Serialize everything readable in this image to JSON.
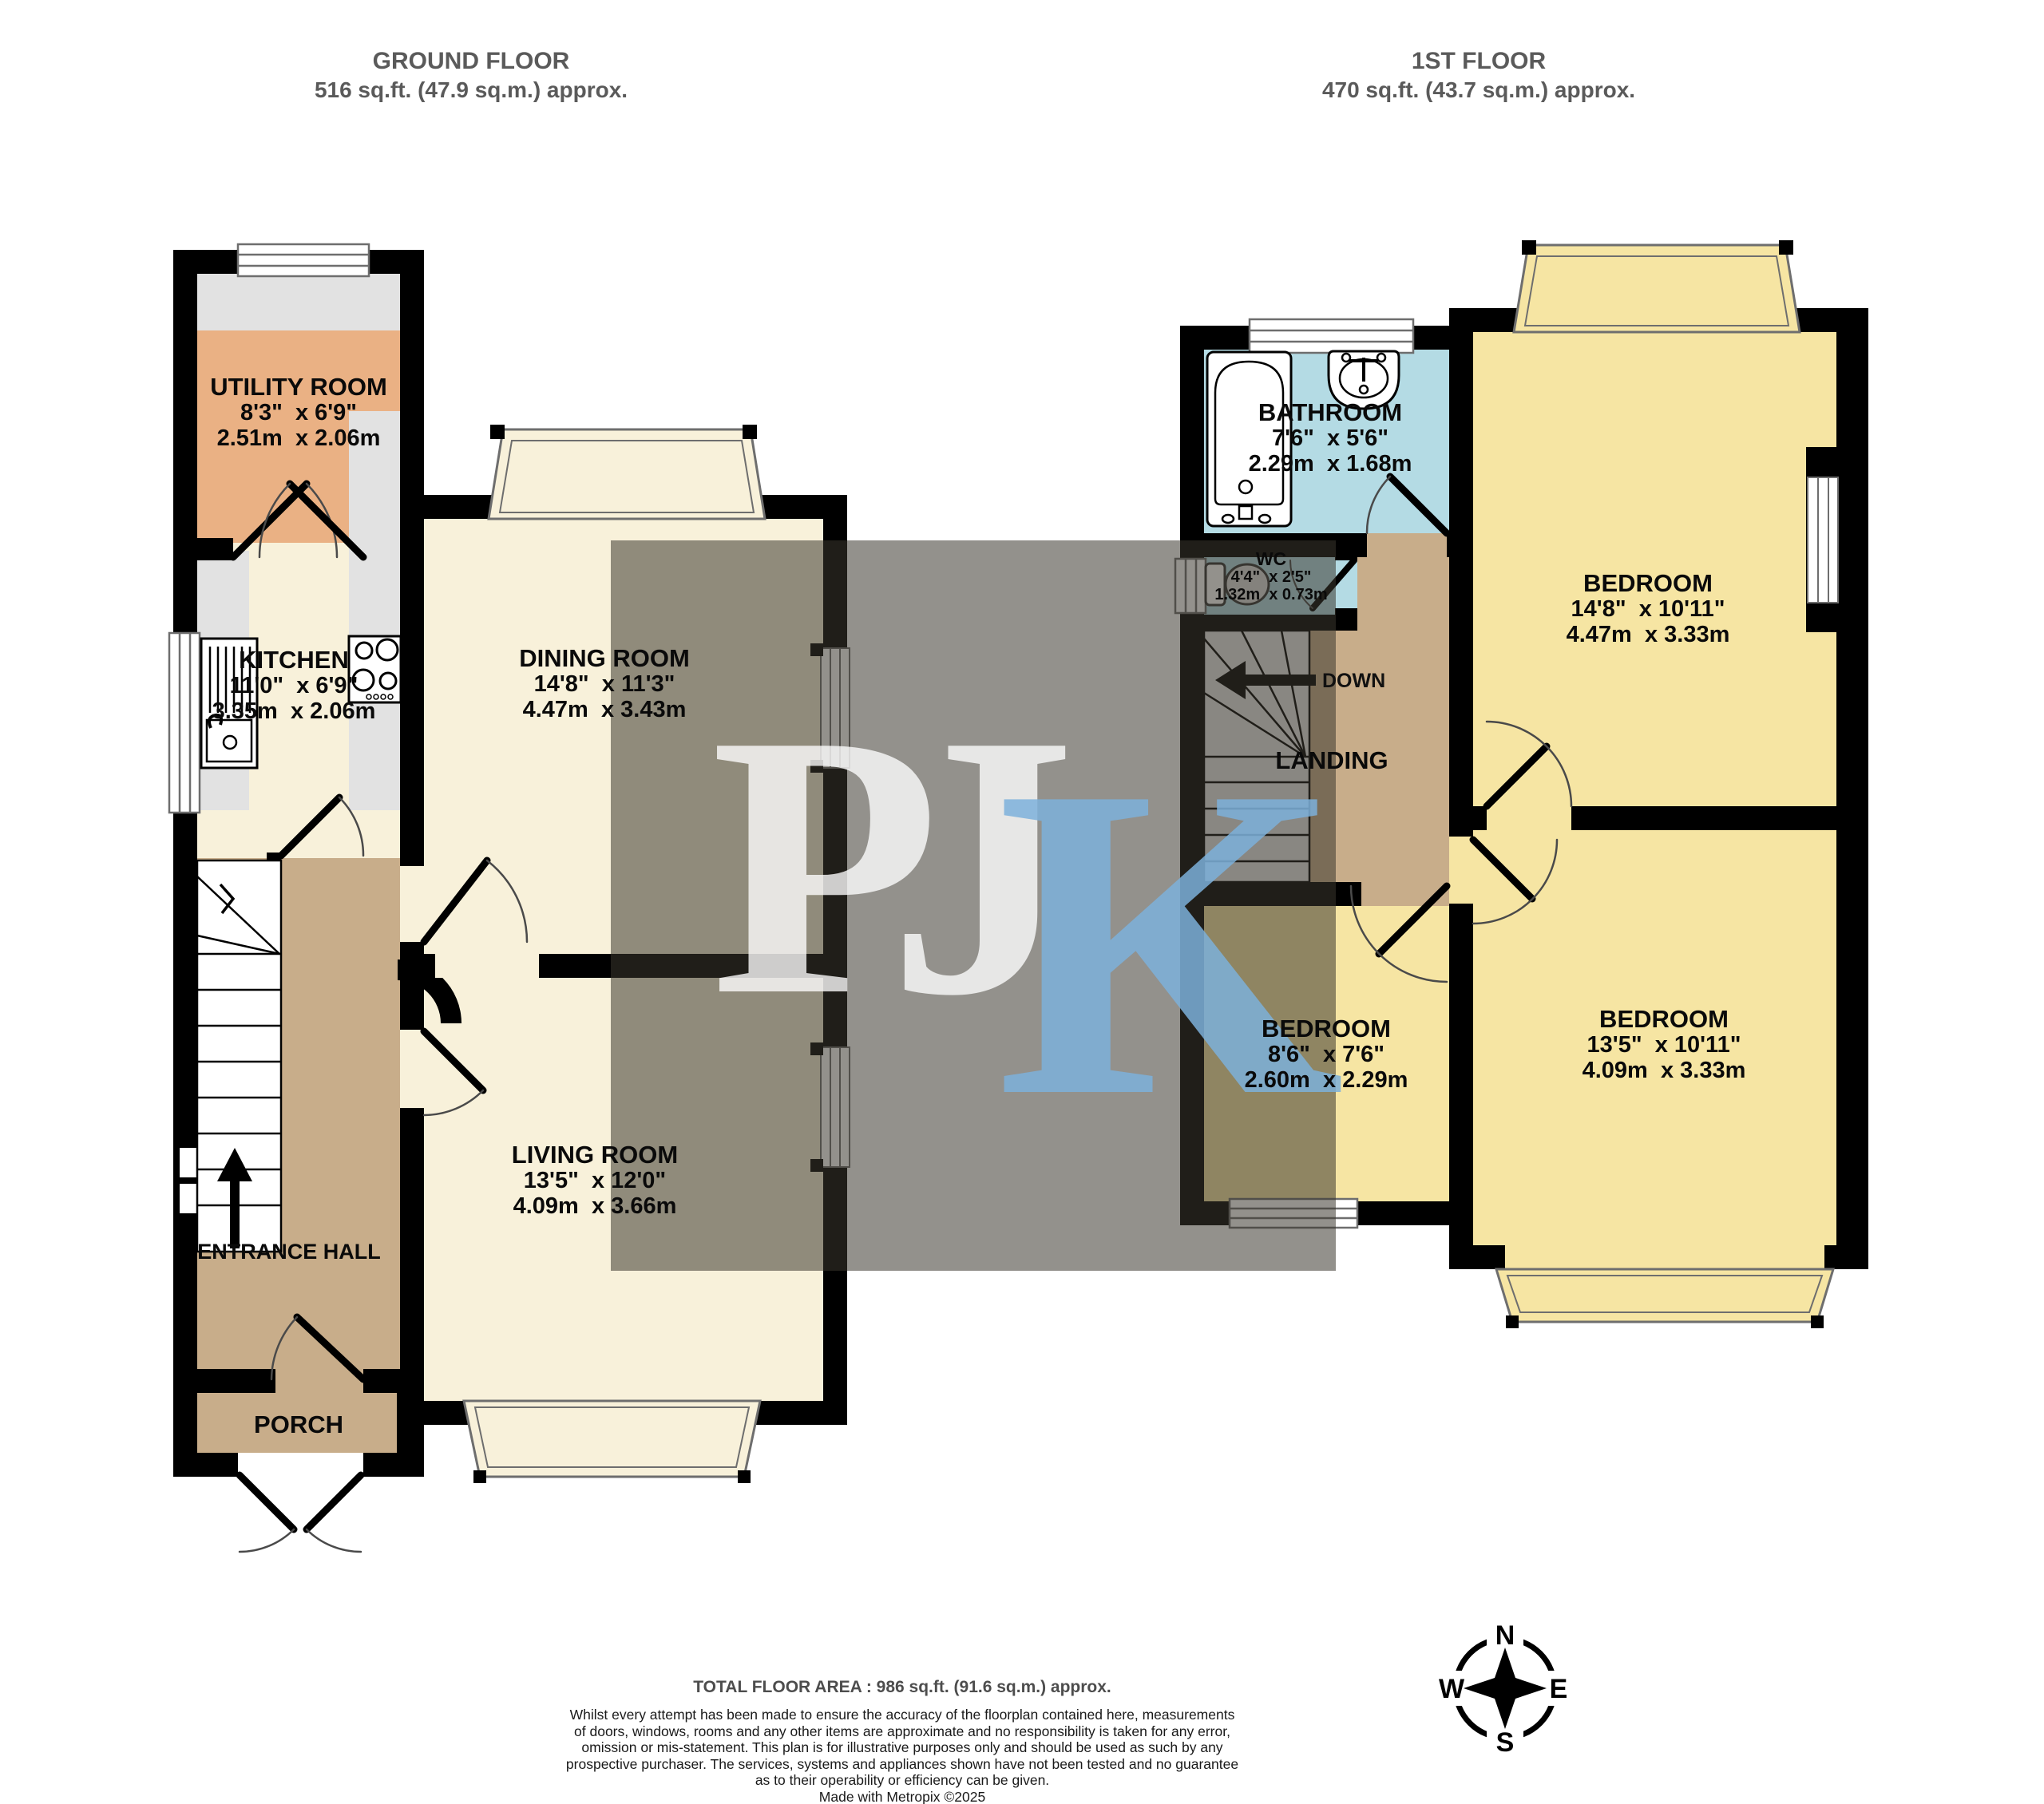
{
  "headers": {
    "ground": {
      "title": "GROUND FLOOR",
      "area": "516 sq.ft. (47.9 sq.m.) approx."
    },
    "first": {
      "title": "1ST FLOOR",
      "area": "470 sq.ft. (43.7 sq.m.) approx."
    }
  },
  "rooms": {
    "utility": {
      "name": "UTILITY ROOM",
      "imperial": "8'3\"  x 6'9\"",
      "metric": "2.51m  x 2.06m",
      "floor_color": "#eab184"
    },
    "kitchen": {
      "name": "KITCHEN",
      "imperial": "11'0\"  x 6'9\"",
      "metric": "3.35m  x 2.06m",
      "floor_color": "#f8f1da"
    },
    "dining": {
      "name": "DINING ROOM",
      "imperial": "14'8\"  x 11'3\"",
      "metric": "4.47m  x 3.43m",
      "floor_color": "#f8f1da"
    },
    "living": {
      "name": "LIVING ROOM",
      "imperial": "13'5\"  x 12'0\"",
      "metric": "4.09m  x 3.66m",
      "floor_color": "#f8f1da"
    },
    "entrance_hall": {
      "name": "ENTRANCE HALL",
      "floor_color": "#c8ad8a"
    },
    "porch": {
      "name": "PORCH",
      "floor_color": "#c8ad8a"
    },
    "bathroom": {
      "name": "BATHROOM",
      "imperial": "7'6\"  x 5'6\"",
      "metric": "2.29m  x 1.68m",
      "floor_color": "#b4dbe4"
    },
    "wc": {
      "name": "WC",
      "imperial": "4'4\"  x 2'5\"",
      "metric": "1.32m  x 0.73m",
      "floor_color": "#b4dbe4"
    },
    "landing": {
      "name": "LANDING",
      "floor_color": "#c8ad8a"
    },
    "bedroom1": {
      "name": "BEDROOM",
      "imperial": "14'8\"  x 10'11\"",
      "metric": "4.47m  x 3.33m",
      "floor_color": "#f6e5a3"
    },
    "bedroom2": {
      "name": "BEDROOM",
      "imperial": "8'6\"  x 7'6\"",
      "metric": "2.60m  x 2.29m",
      "floor_color": "#f6e5a3"
    },
    "bedroom3": {
      "name": "BEDROOM",
      "imperial": "13'5\"  x 10'11\"",
      "metric": "4.09m  x 3.33m",
      "floor_color": "#f6e5a3"
    }
  },
  "stairs": {
    "first_floor_direction_label": "DOWN"
  },
  "watermark": {
    "letters": [
      "P",
      "J",
      "K"
    ],
    "pj_color": "#ffffff",
    "k_color": "#7db0da",
    "overlay_color": "#3b362e"
  },
  "compass": {
    "north": "N",
    "east": "E",
    "south": "S",
    "west": "W"
  },
  "footer": {
    "total_area": "TOTAL FLOOR AREA : 986 sq.ft. (91.6 sq.m.) approx.",
    "disclaimer_lines": [
      "Whilst every attempt has been made to ensure the accuracy of the floorplan contained here, measurements",
      "of doors, windows, rooms and any other items are approximate and no responsibility is taken for any error,",
      "omission or mis-statement. This plan is for illustrative purposes only and should be used as such by any",
      "prospective purchaser. The services, systems and appliances shown have not been tested and no guarantee",
      "as to their operability or efficiency can be given.",
      "Made with Metropix ©2025"
    ]
  }
}
